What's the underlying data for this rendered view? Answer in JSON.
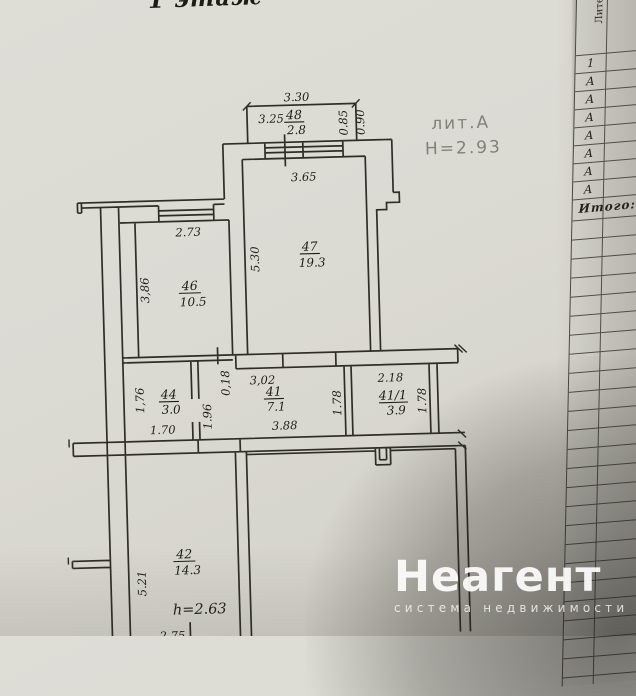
{
  "floor_title": "1 этаж",
  "plan": {
    "litera": "лит.А",
    "building_height": "Н=2.93",
    "ceiling_height_note": "h=2.63",
    "rooms": {
      "r48": {
        "num": "48",
        "area": "2.8"
      },
      "r47": {
        "num": "47",
        "area": "19.3"
      },
      "r46": {
        "num": "46",
        "area": "10.5"
      },
      "r44": {
        "num": "44",
        "area": "3.0"
      },
      "r41": {
        "num": "41",
        "area": "7.1"
      },
      "r41_1": {
        "num": "41/1",
        "area": "3.9"
      },
      "r42": {
        "num": "42",
        "area": "14.3"
      }
    },
    "dims": {
      "balcony_width": "3.30",
      "balcony_inner": "3.25",
      "balcony_d1": "0.85",
      "balcony_d2": "0.90",
      "r47_width": "3.65",
      "r47_depth": "5.30",
      "r46_width": "2.73",
      "r46_depth": "3,86",
      "wall_thickness": "0,18",
      "corridor_width": "3,02",
      "r44_depth": "1,76",
      "r44_width": "1.70",
      "corridor_seg": "1.96",
      "corridor_width2": "3.88",
      "r41_depth": "1.78",
      "r41_1_width": "2.18",
      "r41_1_depth": "1.78",
      "r42_depth": "5.21",
      "r42_width": "2.75"
    }
  },
  "side_table": {
    "col1_header": "Литера по п",
    "col2_header": "Эт",
    "rows": [
      "1",
      "А",
      "А",
      "А",
      "А",
      "А",
      "А",
      "А"
    ],
    "total": "Итого:"
  },
  "watermark": {
    "brand": "Неагент",
    "tagline": "система недвижимости"
  }
}
